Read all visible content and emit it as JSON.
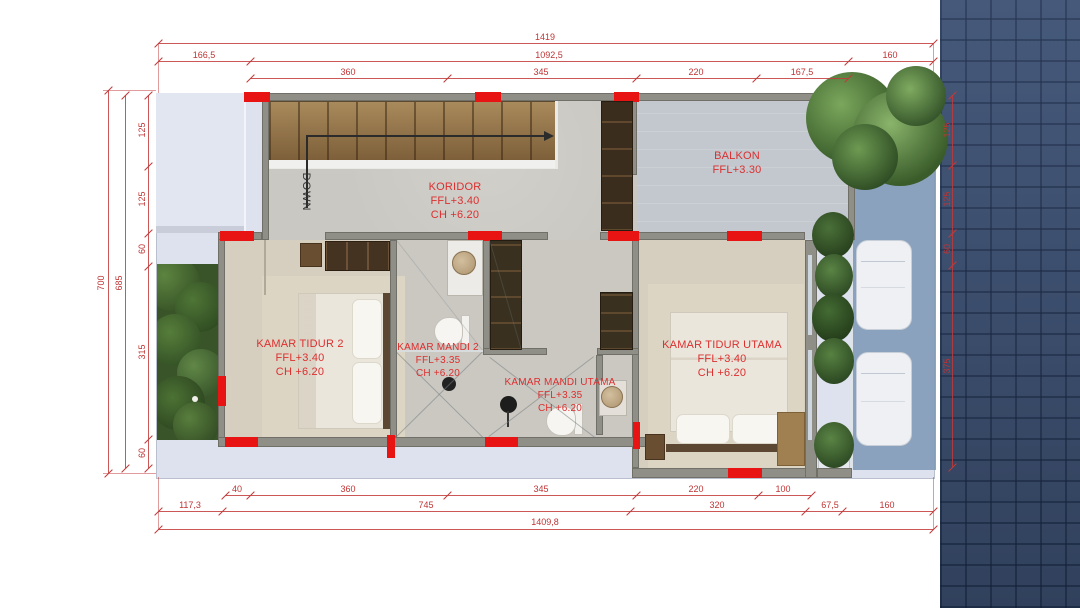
{
  "plan": {
    "rooms": [
      {
        "id": "koridor",
        "name": "KORIDOR",
        "ffl": "FFL+3.40",
        "ch": "CH +6.20"
      },
      {
        "id": "balkon",
        "name": "BALKON",
        "ffl": "FFL+3.30",
        "ch": ""
      },
      {
        "id": "kamar-tidur-2",
        "name": "KAMAR TIDUR 2",
        "ffl": "FFL+3.40",
        "ch": "CH +6.20"
      },
      {
        "id": "kamar-mandi-2",
        "name": "KAMAR MANDI 2",
        "ffl": "FFL+3.35",
        "ch": "CH +6.20"
      },
      {
        "id": "kamar-mandi-utama",
        "name": "KAMAR MANDI UTAMA",
        "ffl": "FFL+3.35",
        "ch": "CH +6.20"
      },
      {
        "id": "kamar-tidur-utama",
        "name": "KAMAR TIDUR UTAMA",
        "ffl": "FFL+3.40",
        "ch": "CH +6.20"
      }
    ],
    "stairs": {
      "label": "DOWN"
    },
    "dimensions": {
      "top": {
        "row1": [
          "1419"
        ],
        "row2": [
          "166,5",
          "1092,5",
          "160"
        ],
        "row3": [
          "360",
          "345",
          "220",
          "167,5"
        ]
      },
      "bottom": {
        "row1": [
          "40",
          "360",
          "345",
          "220",
          "100"
        ],
        "row2": [
          "117,3",
          "745",
          "320",
          "67,5",
          "160"
        ],
        "row3": [
          "1409,8"
        ]
      },
      "left": {
        "overall": "700",
        "inner": "685",
        "segments": [
          "125",
          "125",
          "60",
          "315",
          "60"
        ]
      },
      "right": {
        "segments": [
          "125",
          "125",
          "60",
          "375"
        ]
      }
    },
    "colors": {
      "dimension_red": "#bf3434",
      "column_marker_red": "#e81414",
      "room_label_red": "#dc2f2f"
    }
  }
}
